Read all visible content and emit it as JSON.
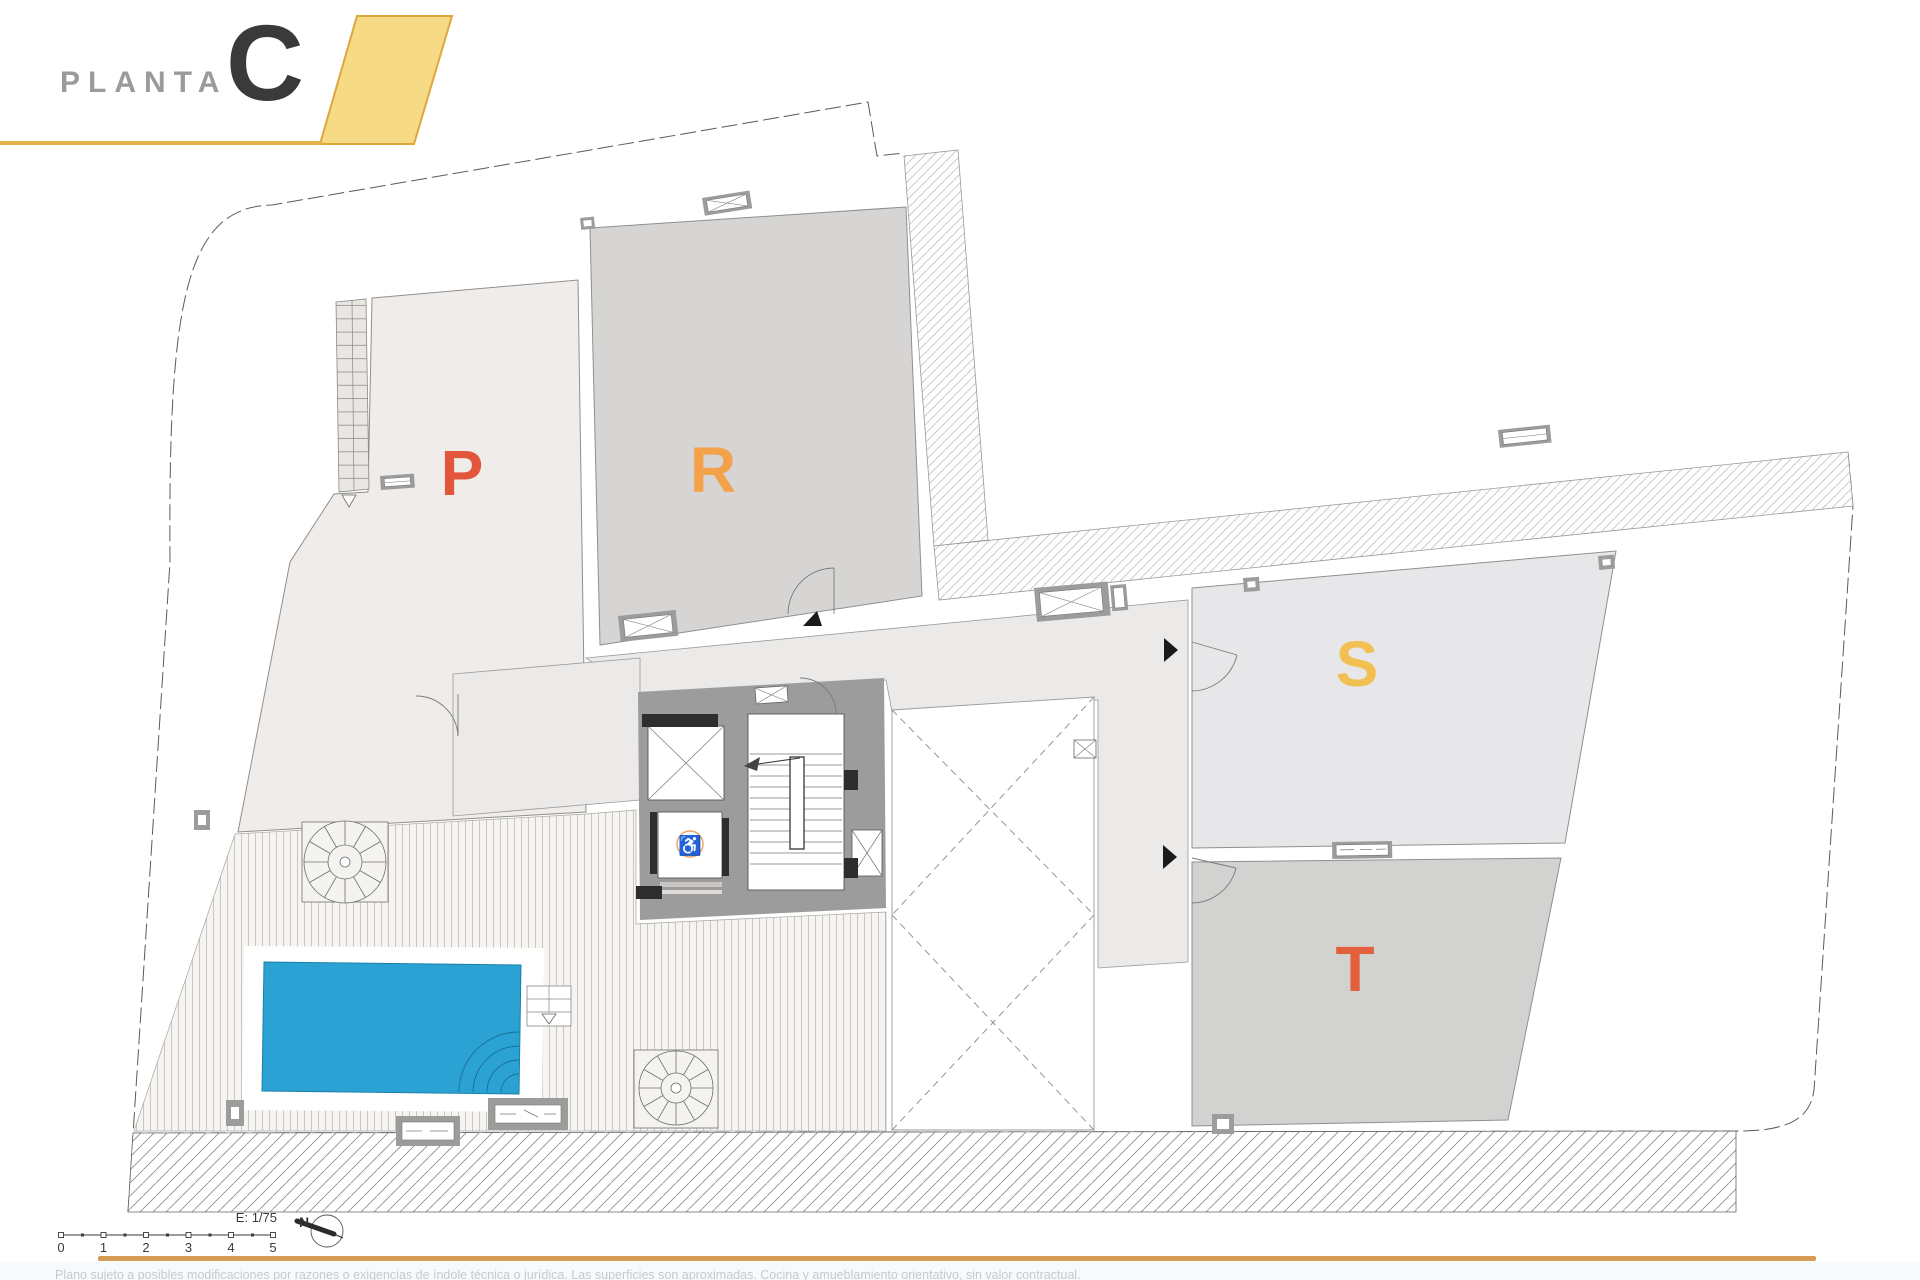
{
  "header": {
    "plan_word": "PLANTA",
    "plan_letter": "C"
  },
  "units": [
    {
      "id": "P",
      "label": "P",
      "color": "#E2573B"
    },
    {
      "id": "R",
      "label": "R",
      "color": "#F3A14B"
    },
    {
      "id": "S",
      "label": "S",
      "color": "#F2C052"
    },
    {
      "id": "T",
      "label": "T",
      "color": "#E2613C"
    }
  ],
  "scalebar": {
    "label": "E: 1/75",
    "ticks": [
      "0",
      "1",
      "2",
      "3",
      "4",
      "5"
    ]
  },
  "north_label": "N",
  "footer": {
    "disclaimer": "Plano sujeto a posibles modificaciones por razones o exigencias de índole técnica o jurídica. Las superficies son aproximadas. Cocina y amueblamiento orientativo, sin valor contractual.",
    "rule_color": "#D79A55"
  },
  "colors": {
    "pool": "#2AA3D4",
    "accent_yellow": "#F6DA85",
    "accent_yellow_border": "#DBA83E",
    "core_wall": "#9C9C9C",
    "floor_p": "#EFECEA",
    "floor_r": "#D6D5D3",
    "floor_s": "#E7E7EA",
    "floor_t": "#D2D2D0",
    "corridor": "#ECEAE8"
  },
  "icons": {
    "accessibility": "♿"
  }
}
